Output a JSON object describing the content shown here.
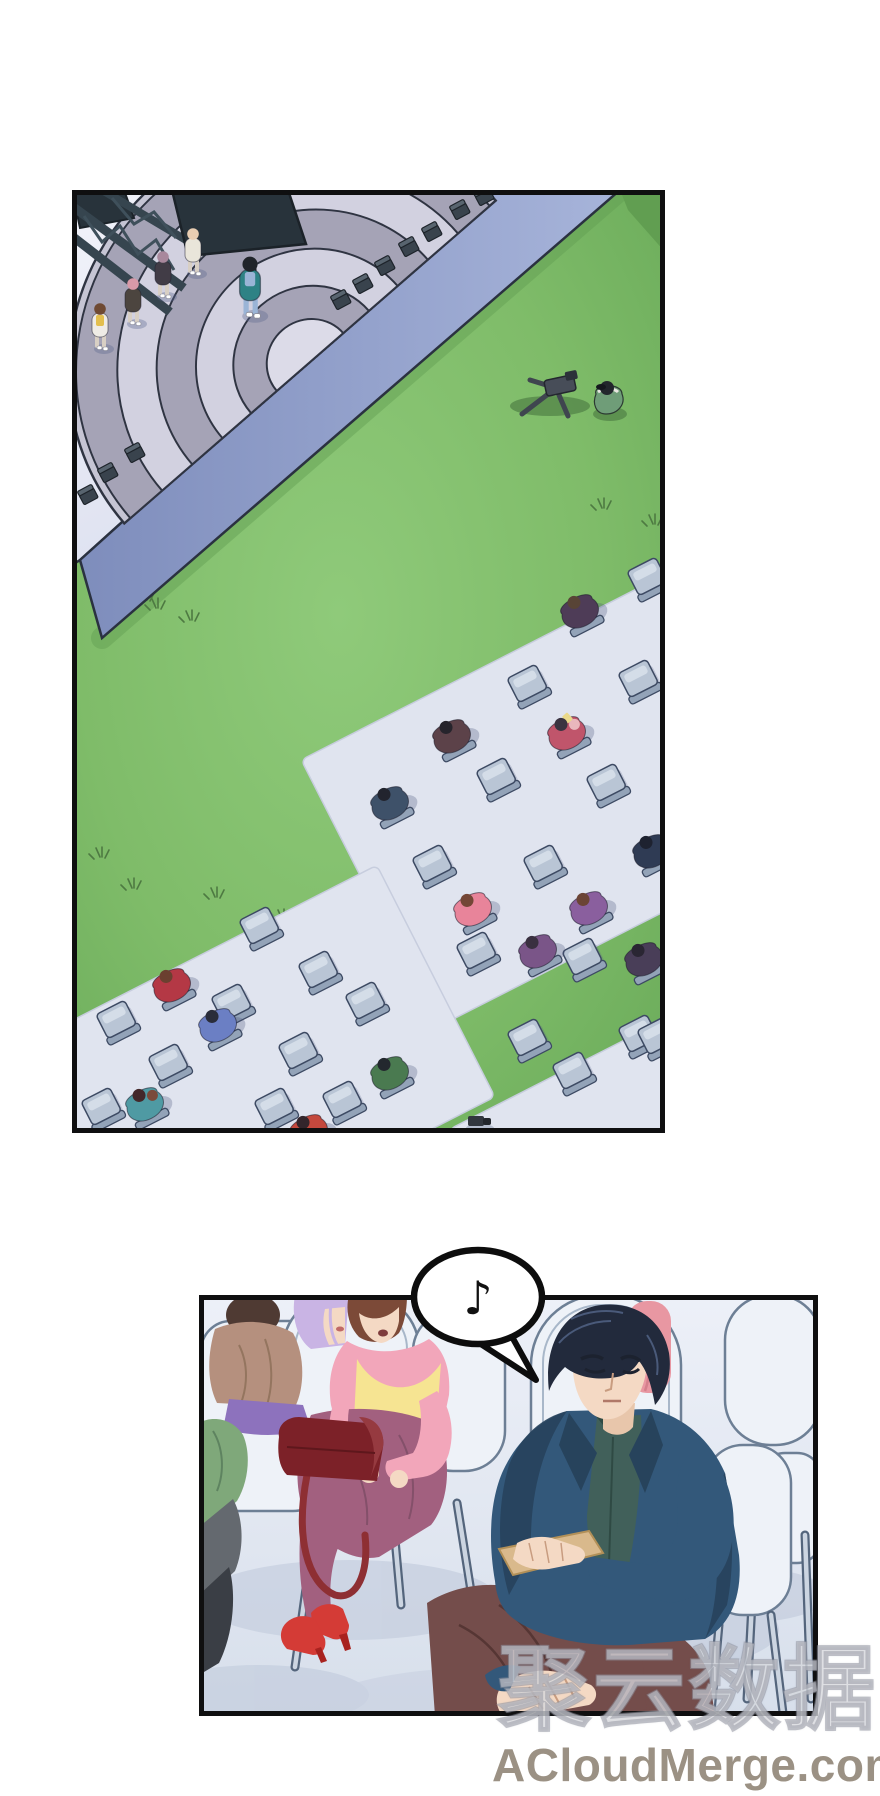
{
  "watermark": {
    "cn": "聚云数据",
    "en": "ACloudMerge.com"
  },
  "bubble": {
    "note": "♪"
  },
  "palette": {
    "grass": "#7fbc69",
    "grassLight": "#8fca7a",
    "grassDark": "#619e52",
    "mat": "#e0e4ef",
    "matline": "#c7cdde",
    "chair": "#b9c5d5",
    "chairHi": "#d4dde8",
    "chairBack": "#93a3b8",
    "chairLine": "#3d4a63",
    "stageTop1": "#f2f3fa",
    "stageTop2": "#d9ddee",
    "stageSide1": "#a0aed5",
    "stageSide2": "#7e8dbc",
    "domeDark": "#a5a3b6",
    "domeLight": "#d2d1e0",
    "domeInner": "#dcdbe8",
    "domeLine": "#2f3442",
    "truss": "#36454f",
    "speaker": "#28333b",
    "cube": "#39434d",
    "cubeTop": "#58646f",
    "tuft": "#4e7a42",
    "wall1": "#edf0f8",
    "wall2": "#d7dfeb",
    "floorshadow": "#c3ccdd",
    "wchair": "#eef2f8",
    "wchairline": "#6d7f95",
    "steel": "#ccd5e1",
    "steelline": "#54657c",
    "skin": "#f4d9c4",
    "mhair": "#222a3c",
    "mhairhi": "#4a5a7a",
    "suit": "#33587a",
    "suitdark": "#27435c",
    "shirt": "#41605a",
    "card": "#d9b98c",
    "mpants": "#744d4b",
    "whair": "#7c4a38",
    "pink": "#f2a6ba",
    "yellow": "#f6e492",
    "wpants": "#a2607f",
    "heel": "#d43b36",
    "bag": "#7c2128",
    "baghi": "#963a40",
    "strap": "#8e2f33",
    "lavhair": "#c9b4e4",
    "tantop": "#b5907e",
    "tanhair": "#4f3a33",
    "purpleskirt": "#8d72bd",
    "orange": "#d9a05c",
    "navy": "#3d4d6b",
    "pinkp": "#e897a2",
    "green": "#7fa87a",
    "gray": "#64696f",
    "darkfg": "#3a3e45",
    "bubbleFill": "#ffffff",
    "bubbleLine": "#0d0d0d",
    "border": "#0f0f10"
  },
  "panel1": {
    "rotation": -27,
    "mats": [
      {
        "cx": 520,
        "cy": 590,
        "w": 500,
        "h": 300
      },
      {
        "cx": 150,
        "cy": 900,
        "w": 480,
        "h": 260
      },
      {
        "cx": 590,
        "cy": 960,
        "w": 360,
        "h": 230
      }
    ],
    "chairs": [
      [
        575,
        386
      ],
      [
        455,
        493
      ],
      [
        566,
        488
      ],
      [
        424,
        586
      ],
      [
        534,
        592
      ],
      [
        360,
        673
      ],
      [
        471,
        673
      ],
      [
        404,
        760
      ],
      [
        510,
        766
      ],
      [
        455,
        847
      ],
      [
        566,
        843
      ],
      [
        187,
        735
      ],
      [
        246,
        779
      ],
      [
        159,
        812
      ],
      [
        226,
        860
      ],
      [
        293,
        810
      ],
      [
        44,
        829
      ],
      [
        96,
        872
      ],
      [
        270,
        909
      ],
      [
        202,
        916
      ],
      [
        29,
        916
      ],
      [
        500,
        880
      ],
      [
        585,
        845
      ]
    ],
    "seated": [
      {
        "x": 507,
        "y": 420,
        "body": "#4e3c57",
        "hair": "#584436"
      },
      {
        "x": 379,
        "y": 545,
        "body": "#5c4249",
        "hair": "#26242c"
      },
      {
        "x": 494,
        "y": 542,
        "body": "#c0556b",
        "hair": "#3a3340",
        "accent": "#e9b7bd",
        "item": "#ead98a"
      },
      {
        "x": 317,
        "y": 612,
        "body": "#3e5169",
        "hair": "#22242e"
      },
      {
        "x": 579,
        "y": 660,
        "body": "#2f3b54",
        "hair": "#1e2230"
      },
      {
        "x": 400,
        "y": 718,
        "body": "#e8849a",
        "hair": "#744636"
      },
      {
        "x": 516,
        "y": 717,
        "body": "#8a5f9e",
        "hair": "#6b4435"
      },
      {
        "x": 571,
        "y": 768,
        "body": "#493e58",
        "hair": "#2a2633"
      },
      {
        "x": 465,
        "y": 760,
        "body": "#7a5588",
        "hair": "#3a3040"
      },
      {
        "x": 99,
        "y": 794,
        "body": "#b43845",
        "hair": "#6b4030"
      },
      {
        "x": 145,
        "y": 834,
        "body": "#6b7fc4",
        "hair": "#2a2d3a"
      },
      {
        "x": 72,
        "y": 913,
        "body": "#4f9aa3",
        "hair": "#43282a",
        "accent": "#7a4a3a"
      },
      {
        "x": 236,
        "y": 940,
        "body": "#c4483d",
        "hair": "#33252b"
      },
      {
        "x": 317,
        "y": 882,
        "body": "#4a7a50",
        "hair": "#23282e"
      }
    ],
    "stage_people": [
      {
        "x": 28,
        "y": 135,
        "coat": "#efece6",
        "inner": "#e3bf4e",
        "hair": "#6f4a33"
      },
      {
        "x": 61,
        "y": 110,
        "coat": "#4c453f",
        "inner": null,
        "hair": "#d89aa8"
      },
      {
        "x": 91,
        "y": 83,
        "coat": "#413c46",
        "inner": null,
        "hair": "#a8889c"
      },
      {
        "x": 121,
        "y": 60,
        "coat": "#e9e5da",
        "inner": null,
        "hair": "#e8cdb2"
      },
      {
        "x": 178,
        "y": 95,
        "coat": "#2e8285",
        "inner": "#9ab4d6",
        "hair": "#20242a",
        "big": true
      }
    ],
    "cubes": [
      [
        36,
        283
      ],
      [
        63,
        263
      ],
      [
        16,
        305
      ],
      [
        269,
        110
      ],
      [
        291,
        94
      ],
      [
        313,
        76
      ],
      [
        337,
        57
      ],
      [
        360,
        42
      ],
      [
        388,
        20
      ],
      [
        412,
        6
      ]
    ],
    "tufts": [
      [
        84,
        418
      ],
      [
        28,
        667
      ],
      [
        60,
        698
      ],
      [
        143,
        707
      ],
      [
        210,
        729
      ],
      [
        530,
        318
      ],
      [
        581,
        334
      ],
      [
        73,
        410
      ],
      [
        118,
        430
      ],
      [
        282,
        735
      ]
    ]
  }
}
